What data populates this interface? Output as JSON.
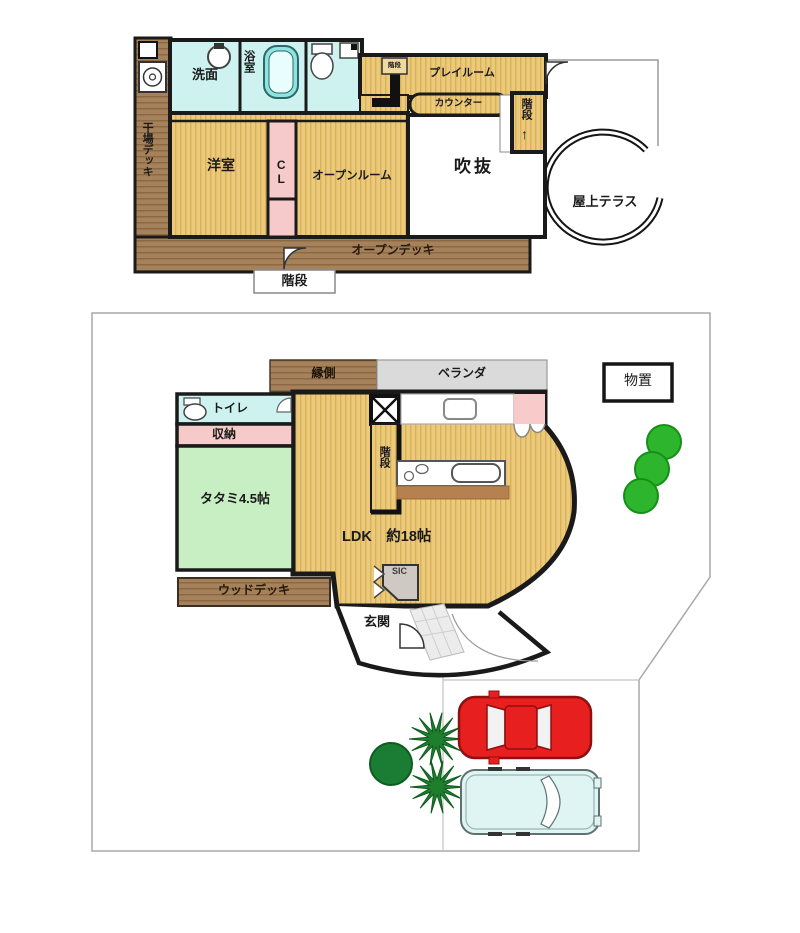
{
  "title": "戸建て間取り図（2階・1階敷地図）",
  "upper": {
    "drying_deck": "干場デッキ",
    "washroom": "洗面",
    "bathroom": "浴室",
    "western_room": "洋室",
    "closet": "CL",
    "open_room": "オープンルーム",
    "playroom": "プレイルーム",
    "counter": "カウンター",
    "stairs_mini": "階段",
    "stairs": "階段",
    "stairs_arrow": "↑",
    "void": "吹抜",
    "roof_terrace": "屋上テラス",
    "open_deck": "オープンデッキ",
    "stairs_box": "階段"
  },
  "lower": {
    "engawa": "縁側",
    "veranda": "ベランダ",
    "toilet": "トイレ",
    "storage": "収納",
    "tatami": "タタミ4.5帖",
    "stairs": "階段",
    "ldk": "LDK　約18帖",
    "sic": "SIC",
    "entrance": "玄関",
    "wood_deck": "ウッドデッキ",
    "shed": "物置"
  },
  "colors": {
    "floor_tan": "#ecca7c",
    "floor_tan_stripe": "#d9b159",
    "deck_brown": "#a6825c",
    "deck_brown_stripe": "#8c6943",
    "water_cyan": "#cdf2ef",
    "bathtub_cyan": "#8fe3e0",
    "closet_pink": "#f6caca",
    "tatami_green": "#c8efc4",
    "veranda_gray": "#dadada",
    "tree_green": "#2db52d",
    "bush_green": "#1b7c33",
    "car_red": "#e71f1f",
    "van_cyan": "#def5f4",
    "wall_black": "#1a1a1a"
  }
}
